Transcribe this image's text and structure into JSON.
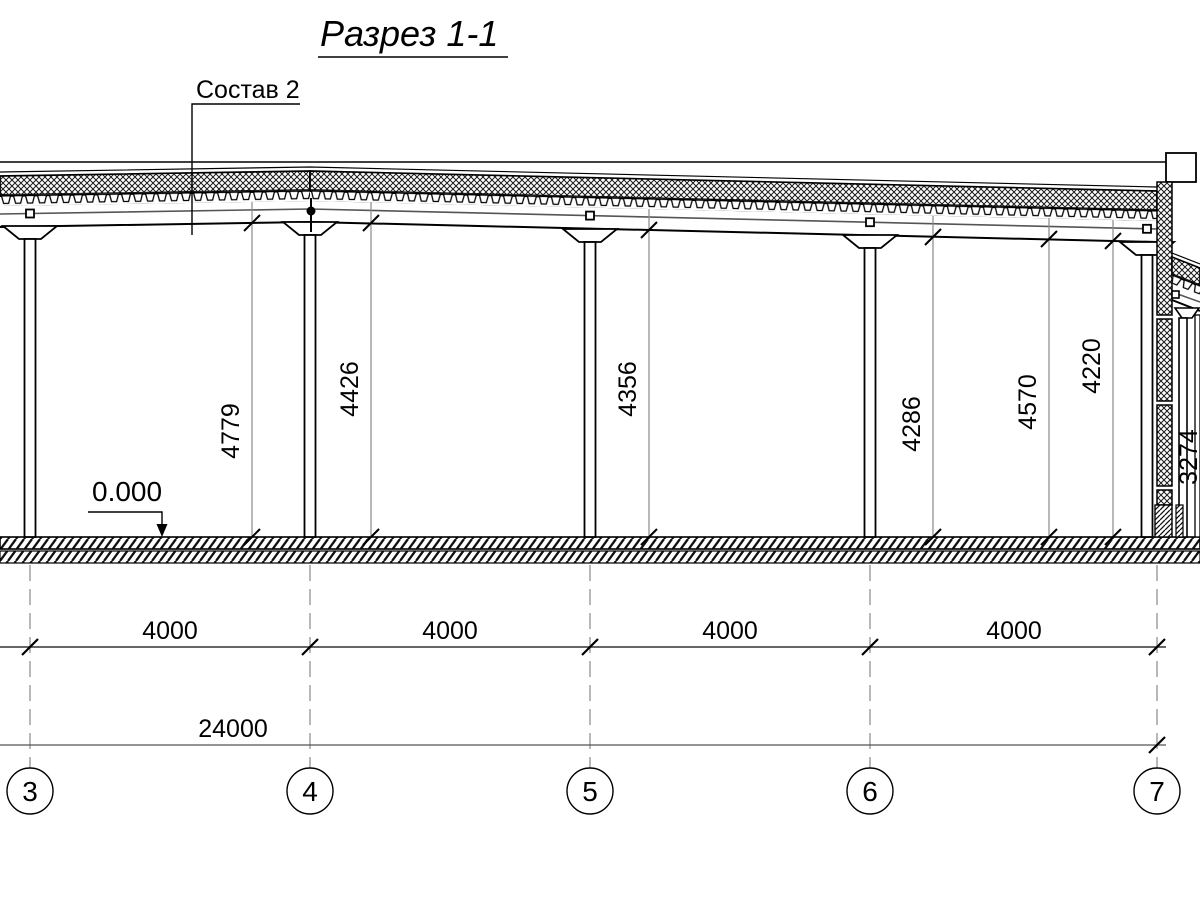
{
  "title": "Разрез 1-1",
  "callout": {
    "label": "Состав 2"
  },
  "level_mark": {
    "value": "0.000"
  },
  "height_dims": [
    {
      "value": "4779"
    },
    {
      "value": "4426"
    },
    {
      "value": "4356"
    },
    {
      "value": "4286"
    },
    {
      "value": "4570"
    },
    {
      "value": "4220"
    },
    {
      "value": "3274"
    }
  ],
  "span_dims": [
    {
      "value": "4000"
    },
    {
      "value": "4000"
    },
    {
      "value": "4000"
    },
    {
      "value": "4000"
    }
  ],
  "total_dim": {
    "value": "24000"
  },
  "axes": [
    {
      "label": "3"
    },
    {
      "label": "4"
    },
    {
      "label": "5"
    },
    {
      "label": "6"
    },
    {
      "label": "7"
    }
  ]
}
